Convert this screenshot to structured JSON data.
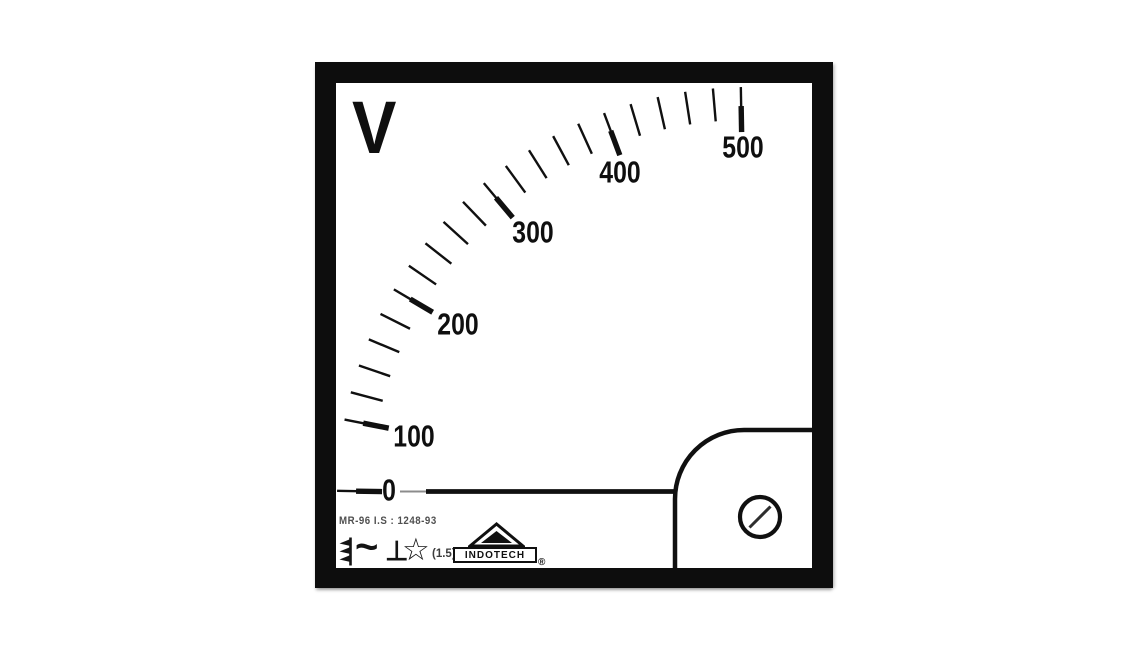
{
  "meter": {
    "unit_label": "V",
    "reading_value": 0,
    "model_standard_text": "MR-96 I.S : 1248-93",
    "brand": {
      "name": "INDOTECH",
      "registered_mark": "®"
    },
    "symbols": {
      "movement_type_icon": "moving-iron-instrument",
      "current_type": "~",
      "mounting_position": "⊥",
      "insulation_test_star": "☆",
      "accuracy_class": "(1.5)"
    },
    "scale": {
      "unit": "V",
      "min": 0,
      "max": 500,
      "minor_step": 20,
      "needle_at_value": 0,
      "majors": [
        {
          "value": 0,
          "label": "0",
          "tick_angle": 179.0,
          "label_angle": 178.7,
          "label_r": 359
        },
        {
          "value": 100,
          "label": "100",
          "tick_angle": 169.0,
          "label_angle": 169.5,
          "label_r": 340
        },
        {
          "value": 200,
          "label": "200",
          "tick_angle": 149.5,
          "label_angle": 149.0,
          "label_r": 338
        },
        {
          "value": 300,
          "label": "300",
          "tick_angle": 130.0,
          "label_angle": 128.9,
          "label_r": 342
        },
        {
          "value": 400,
          "label": "400",
          "tick_angle": 110.5,
          "label_angle": 111.4,
          "label_r": 350
        },
        {
          "value": 500,
          "label": "500",
          "tick_angle": 91.0,
          "label_angle": 90.8,
          "label_r": 351
        }
      ],
      "minor_tick_angles": [
        165.1,
        161.2,
        157.3,
        153.4,
        145.6,
        141.7,
        137.8,
        133.9,
        126.1,
        122.2,
        118.3,
        114.4,
        106.6,
        102.7,
        98.8,
        94.9
      ]
    },
    "colors": {
      "bezel": "#0d0d0d",
      "face": "#ffffff",
      "ink": "#101010",
      "small_text": "#4f4f4f"
    }
  }
}
